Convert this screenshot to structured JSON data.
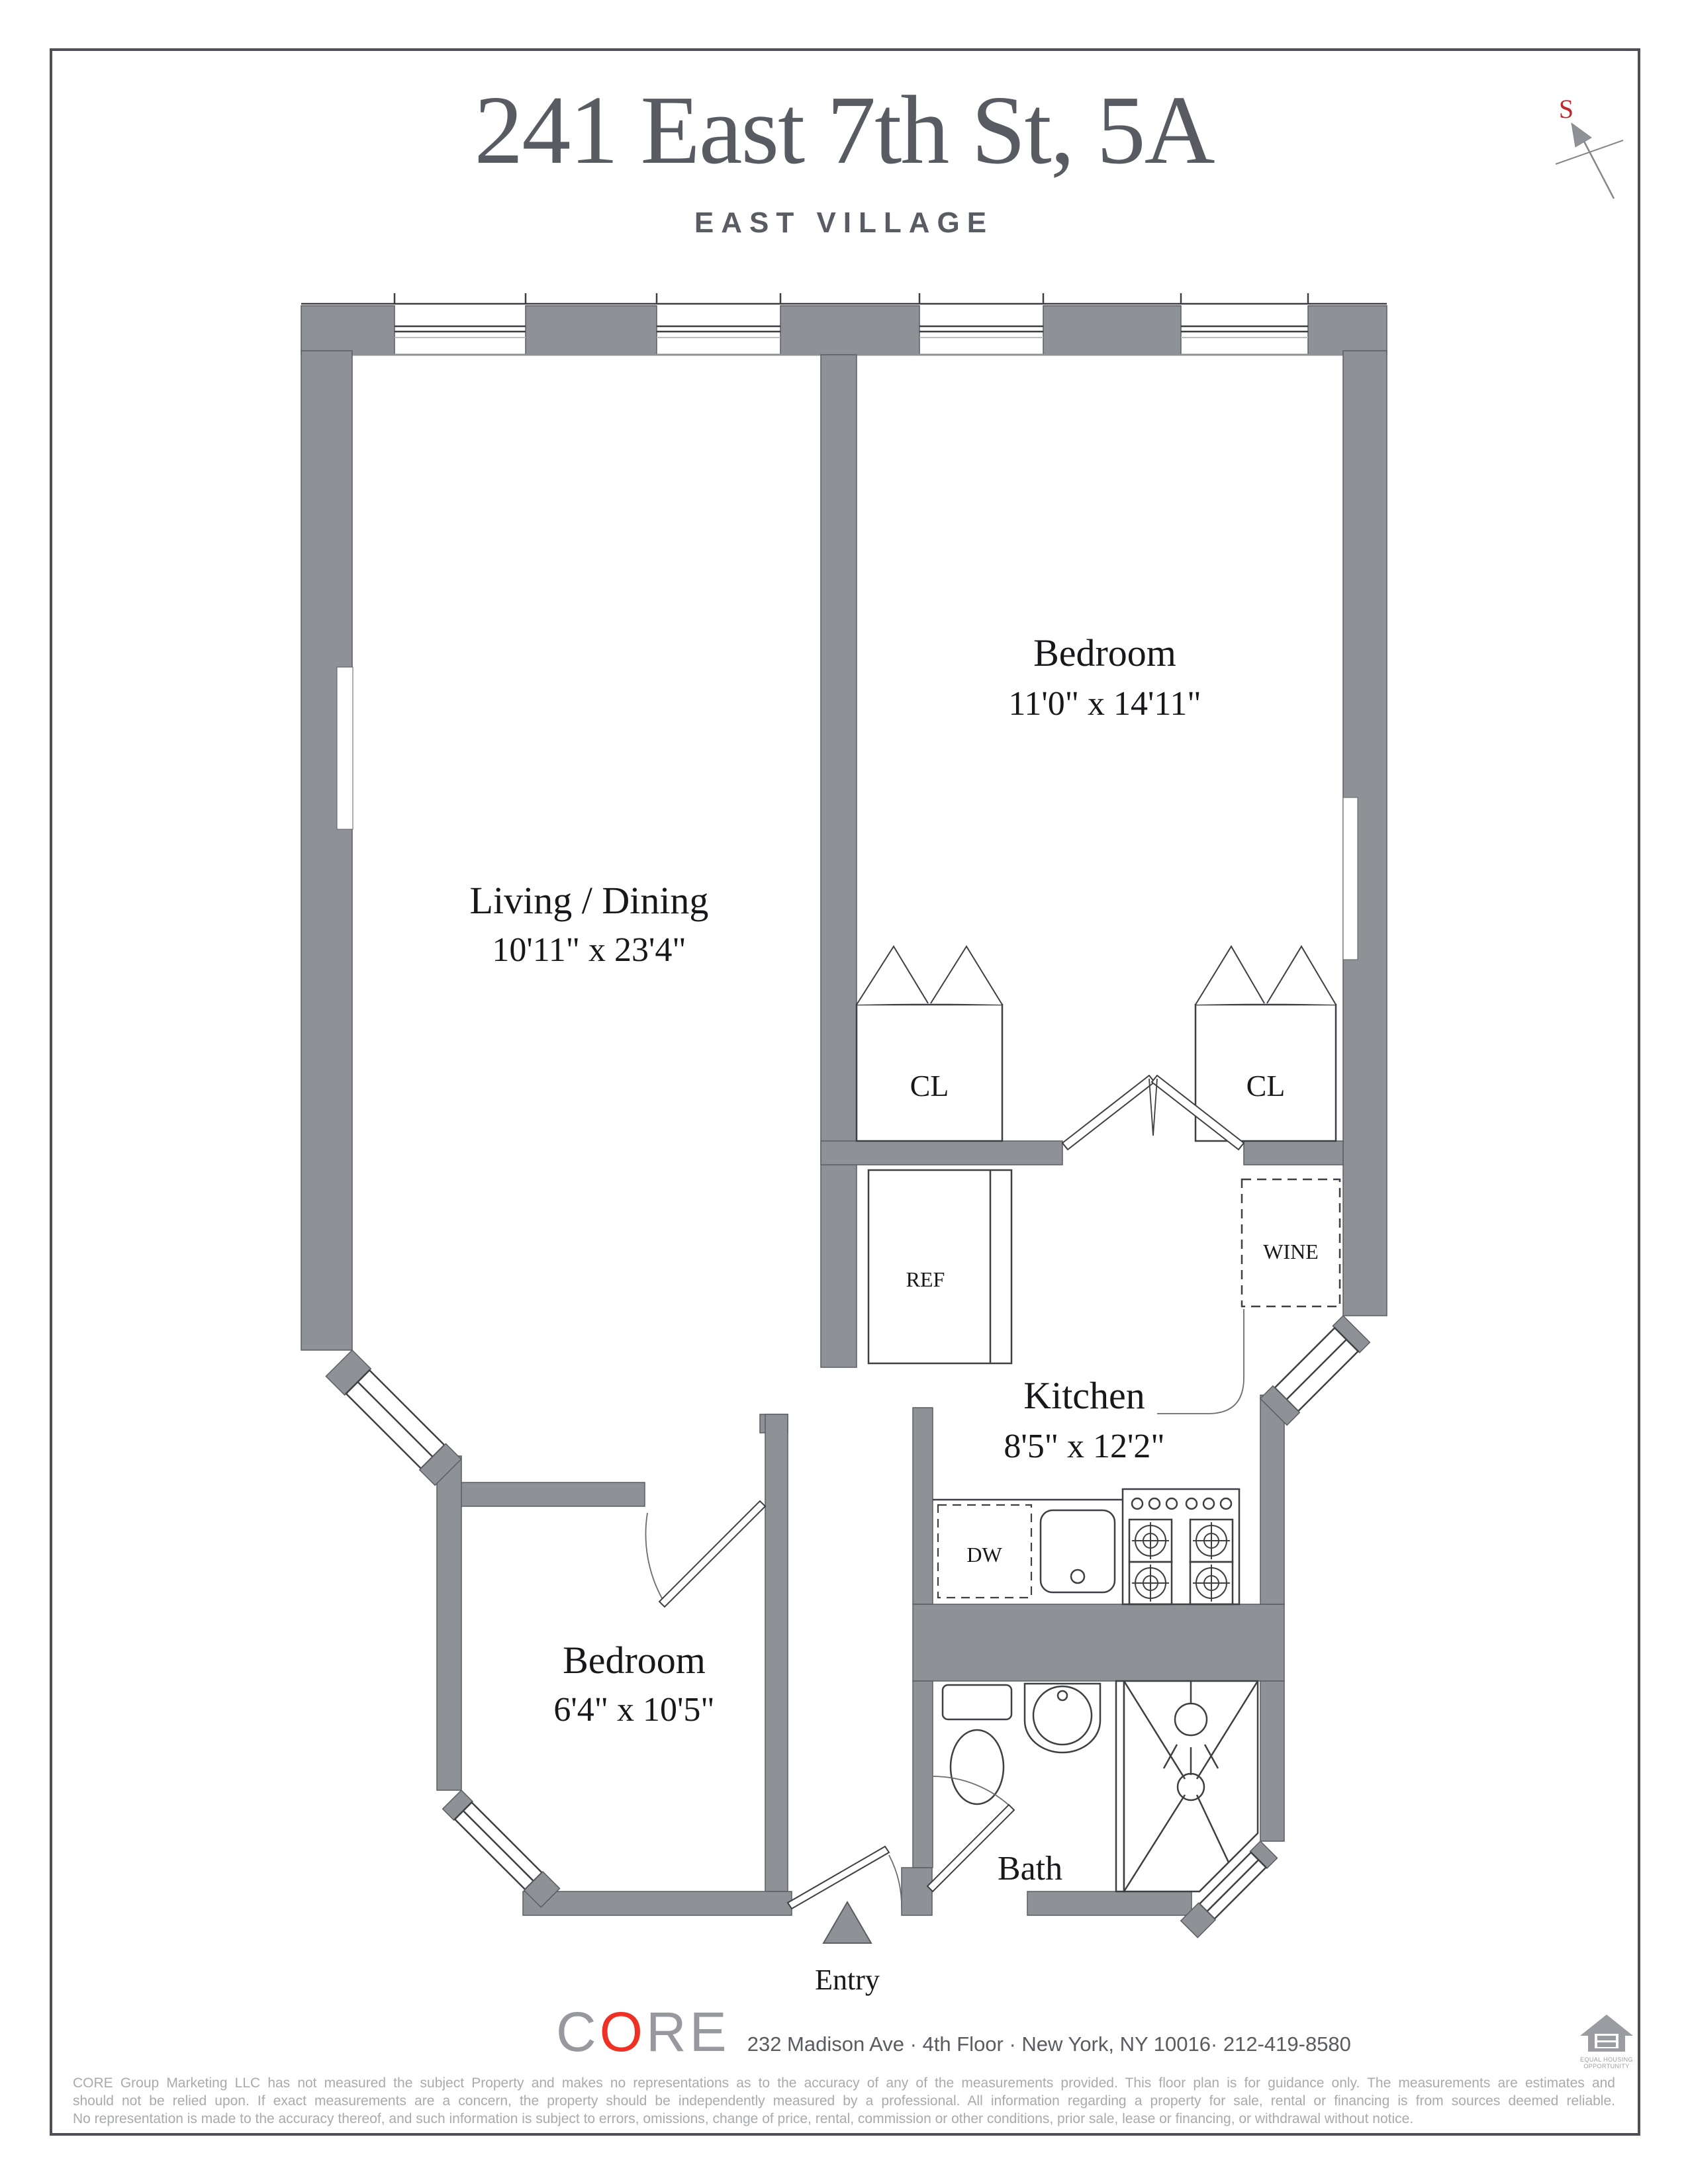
{
  "header": {
    "title": "241 East 7th St, 5A",
    "subtitle": "EAST VILLAGE"
  },
  "compass": {
    "label": "S"
  },
  "rooms": {
    "living": {
      "name": "Living / Dining",
      "dims": "10'11\" x 23'4\""
    },
    "bedroom_upper": {
      "name": "Bedroom",
      "dims": "11'0\" x 14'11\""
    },
    "kitchen": {
      "name": "Kitchen",
      "dims": "8'5\" x 12'2\""
    },
    "bedroom_lower": {
      "name": "Bedroom",
      "dims": "6'4\" x 10'5\""
    },
    "bath": {
      "name": "Bath"
    },
    "entry": {
      "name": "Entry"
    }
  },
  "labels": {
    "closet": "CL",
    "refrigerator": "REF",
    "wine": "WINE",
    "dishwasher": "DW"
  },
  "footer": {
    "brand": {
      "c": "C",
      "o": "O",
      "re": "RE"
    },
    "address": "232 Madison Ave · 4th Floor · New York, NY 10016· 212-419-8580",
    "equal_housing": {
      "line1": "EQUAL HOUSING",
      "line2": "OPPORTUNITY"
    },
    "disclaimer": [
      "CORE Group Marketing LLC has not measured the subject Property and makes no representations as to the accuracy of any of the measurements provided. This floor plan is for guidance only. The measurements are estimates and",
      "should not be relied upon. If exact measurements are a concern, the property should be independently measured by a professional. All information regarding a property for sale, rental or financing is from sources deemed reliable.",
      "No representation is made to the accuracy thereof, and such information is subject to errors, omissions, change of price, rental, commission or other conditions, prior sale, lease or financing, or withdrawal without notice."
    ]
  },
  "colors": {
    "wall": "#8e9196",
    "line": "#3d3f43",
    "title": "#595b63",
    "brand_gray": "#97999e",
    "brand_red": "#ee3124",
    "compass_red": "#c0272d",
    "disclaimer": "#a8aaae"
  }
}
